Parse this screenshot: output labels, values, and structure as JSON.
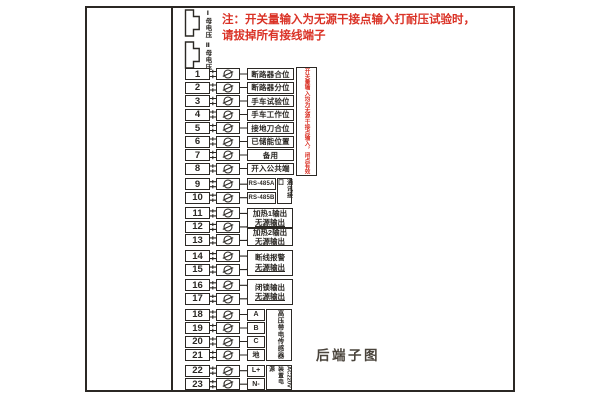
{
  "title": "后端子图",
  "colors": {
    "accent_red": "#da3226",
    "line": "#2b2824",
    "caption": "#4a443c"
  },
  "note": {
    "line1": "注：开关量输入为无源干接点输入打耐压试验时，",
    "line2": "请拔掉所有接线端子"
  },
  "connectors": [
    {
      "label": "Ⅰ母电压"
    },
    {
      "label": "Ⅱ母电压"
    }
  ],
  "terminals": [
    {
      "no": "1",
      "label": "断路器合位"
    },
    {
      "no": "2",
      "label": "断路器分位"
    },
    {
      "no": "3",
      "label": "手车试验位"
    },
    {
      "no": "4",
      "label": "手车工作位"
    },
    {
      "no": "5",
      "label": "接地刀合位"
    },
    {
      "no": "6",
      "label": "已储能位置"
    },
    {
      "no": "7",
      "label": "备用"
    },
    {
      "no": "8",
      "label": "开入公共端"
    },
    {
      "no": "9",
      "label": "RS-485A"
    },
    {
      "no": "10",
      "label": "RS-485B"
    },
    {
      "no": "11",
      "label": null
    },
    {
      "no": "12",
      "label": null
    },
    {
      "no": "13",
      "label": null
    },
    {
      "no": "14",
      "label": null
    },
    {
      "no": "15",
      "label": null
    },
    {
      "no": "16",
      "label": null
    },
    {
      "no": "17",
      "label": null
    },
    {
      "no": "18",
      "label": "A"
    },
    {
      "no": "19",
      "label": "B"
    },
    {
      "no": "20",
      "label": "C"
    },
    {
      "no": "21",
      "label": "地"
    },
    {
      "no": "22",
      "label": "L+"
    },
    {
      "no": "23",
      "label": "N-"
    }
  ],
  "output_groups": [
    {
      "terminals": "11-12",
      "label": "加热1输出",
      "sub": "无源输出"
    },
    {
      "terminals": "12-13",
      "label": "加热2输出",
      "sub": "无源输出"
    },
    {
      "terminals": "14-15",
      "label": "断线报警",
      "sub": "无源输出"
    },
    {
      "terminals": "16-17",
      "label": "闭锁输出",
      "sub": "无源输出"
    }
  ],
  "side_notes": {
    "input_note": "开关量输入均为无源干接点输入，闭点有效",
    "comm": "通讯接口",
    "sensor": "高压带电传感器",
    "power": "装置电源",
    "power_rating": "AC220V"
  },
  "caption": "后端子图"
}
